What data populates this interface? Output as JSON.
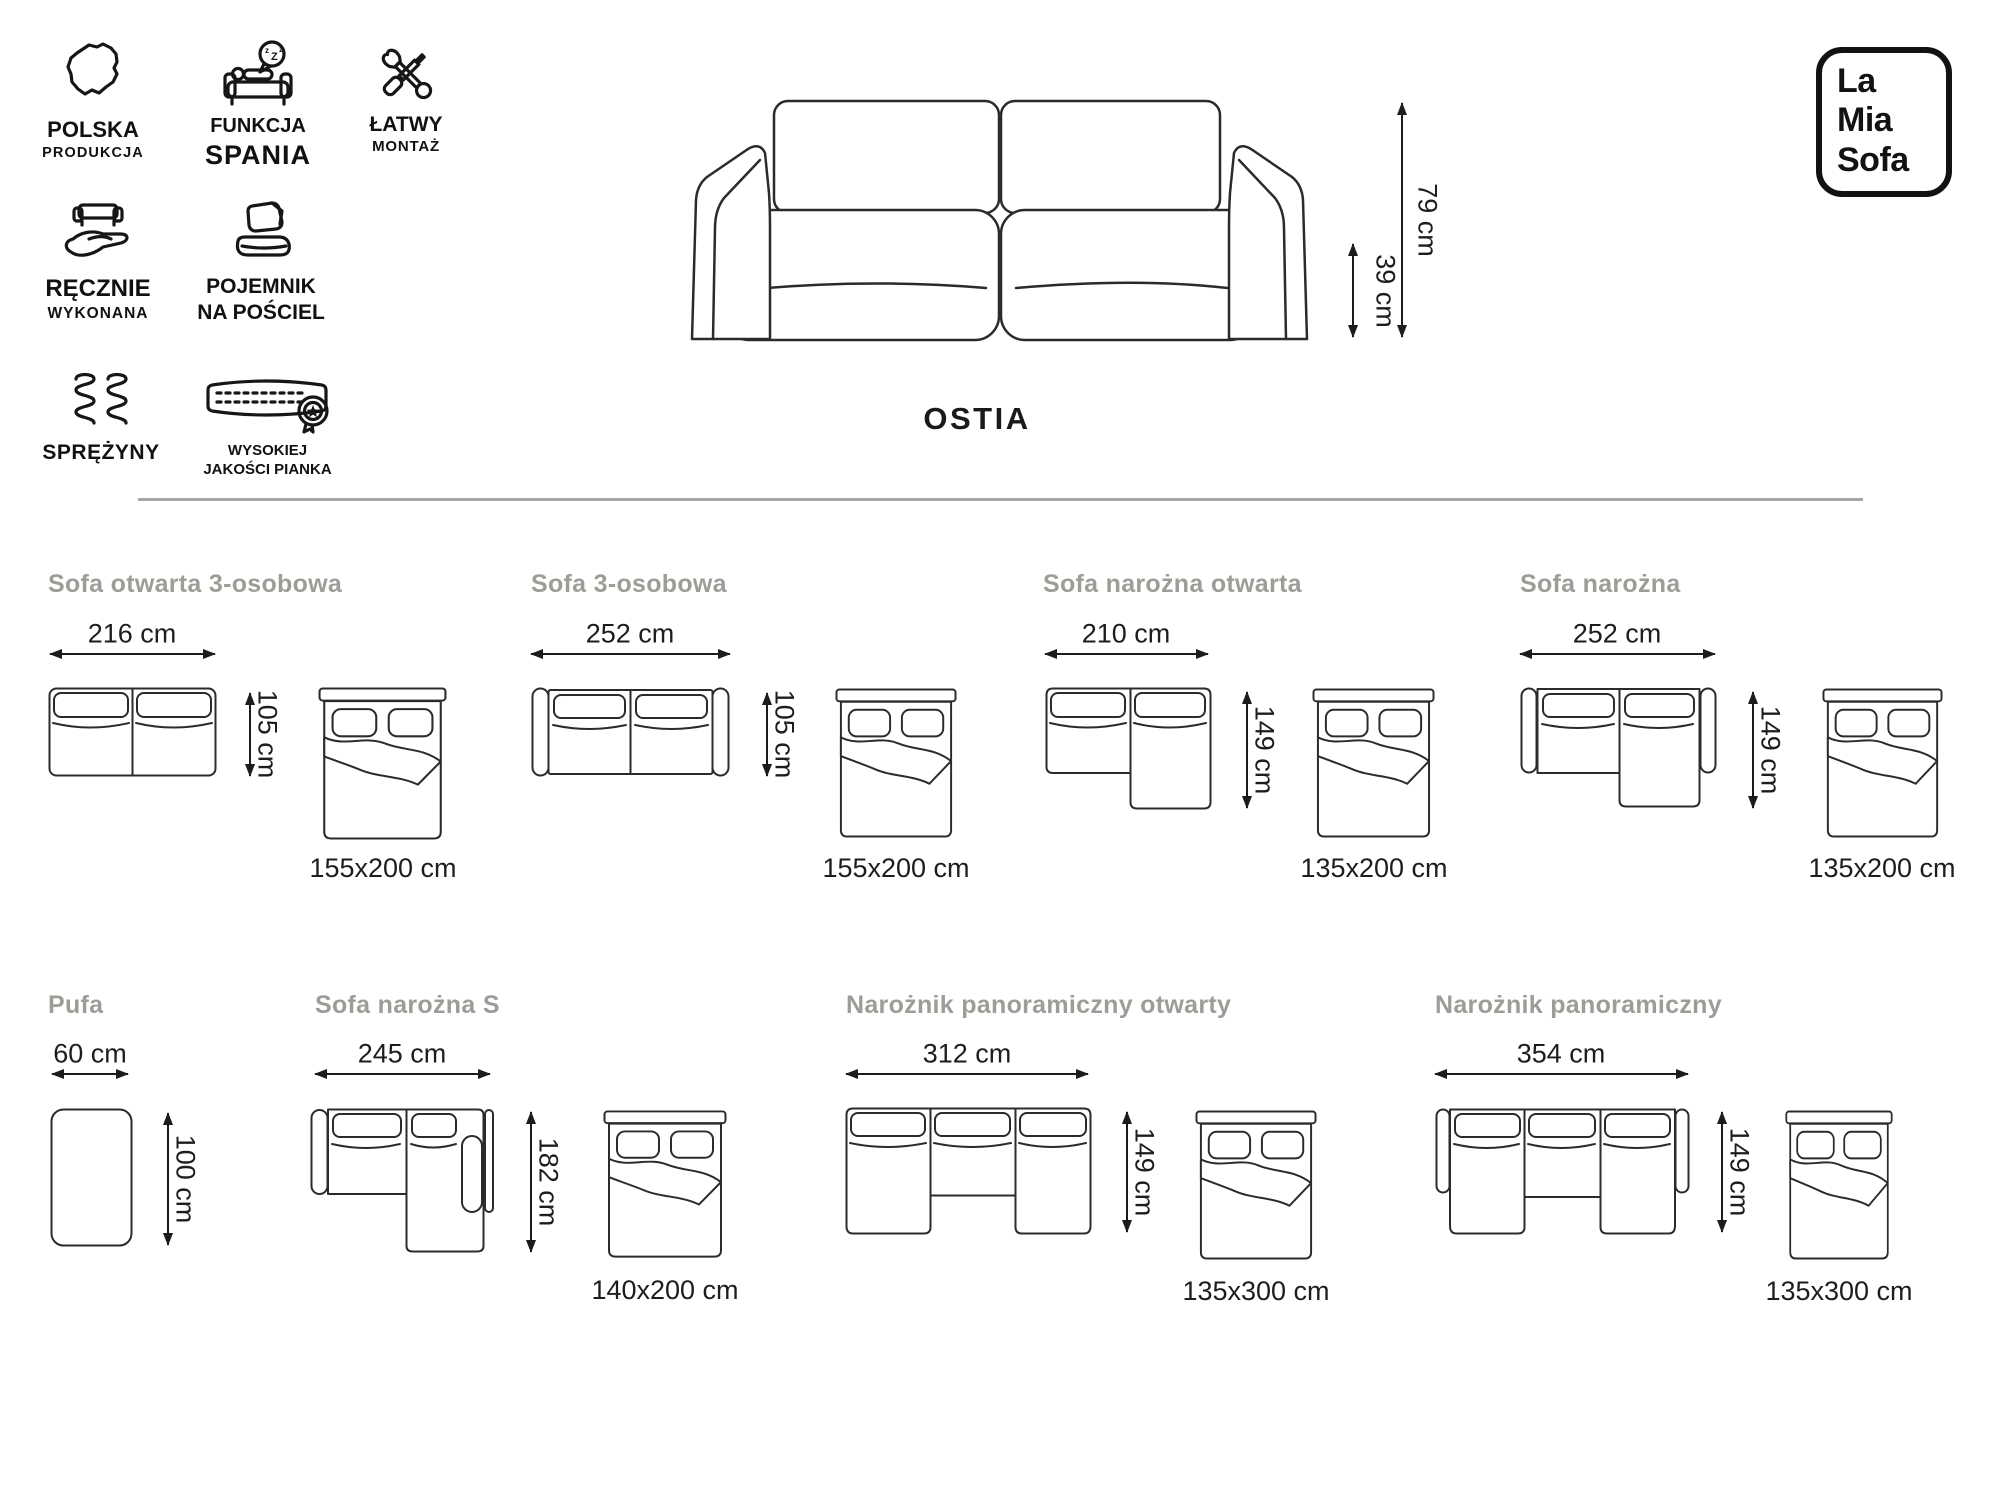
{
  "product_name": "OSTIA",
  "brand": {
    "line1": "La",
    "line2": "Mia",
    "line3": "Sofa"
  },
  "features": [
    {
      "icon": "poland-map-icon",
      "label1": "POLSKA",
      "label2": "PRODUKCJA"
    },
    {
      "icon": "sleep-function-icon",
      "label1": "FUNKCJA",
      "label2": "SPANIA",
      "bubble": [
        "z",
        "Z",
        "z"
      ]
    },
    {
      "icon": "tools-icon",
      "label1": "ŁATWY",
      "label2": "MONTAŻ"
    },
    {
      "icon": "handmade-icon",
      "label1": "RĘCZNIE",
      "label2": "WYKONANA"
    },
    {
      "icon": "bedding-storage-icon",
      "label1": "POJEMNIK",
      "label2": "NA POŚCIEL"
    },
    {
      "icon": "springs-icon",
      "label1": "SPRĘŻYNY"
    },
    {
      "icon": "foam-quality-icon",
      "label1": "WYSOKIEJ",
      "label2": "JAKOŚCI PIANKA"
    }
  ],
  "overall": {
    "height_label": "79 cm",
    "seat_height_label": "39 cm"
  },
  "variants": [
    {
      "name": "Sofa otwarta 3-osobowa",
      "width_label": "216 cm",
      "depth_label": "105 cm",
      "bed_label": "155x200 cm"
    },
    {
      "name": "Sofa 3-osobowa",
      "width_label": "252 cm",
      "depth_label": "105 cm",
      "bed_label": "155x200 cm"
    },
    {
      "name": "Sofa narożna otwarta",
      "width_label": "210 cm",
      "depth_label": "149 cm",
      "bed_label": "135x200 cm"
    },
    {
      "name": "Sofa narożna",
      "width_label": "252 cm",
      "depth_label": "149 cm",
      "bed_label": "135x200 cm"
    },
    {
      "name": "Pufa",
      "width_label": "60 cm",
      "depth_label": "100 cm"
    },
    {
      "name": "Sofa narożna S",
      "width_label": "245 cm",
      "depth_label": "182 cm",
      "bed_label": "140x200 cm"
    },
    {
      "name": "Narożnik panoramiczny otwarty",
      "width_label": "312 cm",
      "depth_label": "149 cm",
      "bed_label": "135x300 cm"
    },
    {
      "name": "Narożnik panoramiczny",
      "width_label": "354 cm",
      "depth_label": "149 cm",
      "bed_label": "135x300 cm"
    }
  ],
  "colors": {
    "ink": "#1c1c1c",
    "line_art": "#2b2b2b",
    "title_gray": "#9d9d97",
    "divider": "#a6a6a6"
  }
}
